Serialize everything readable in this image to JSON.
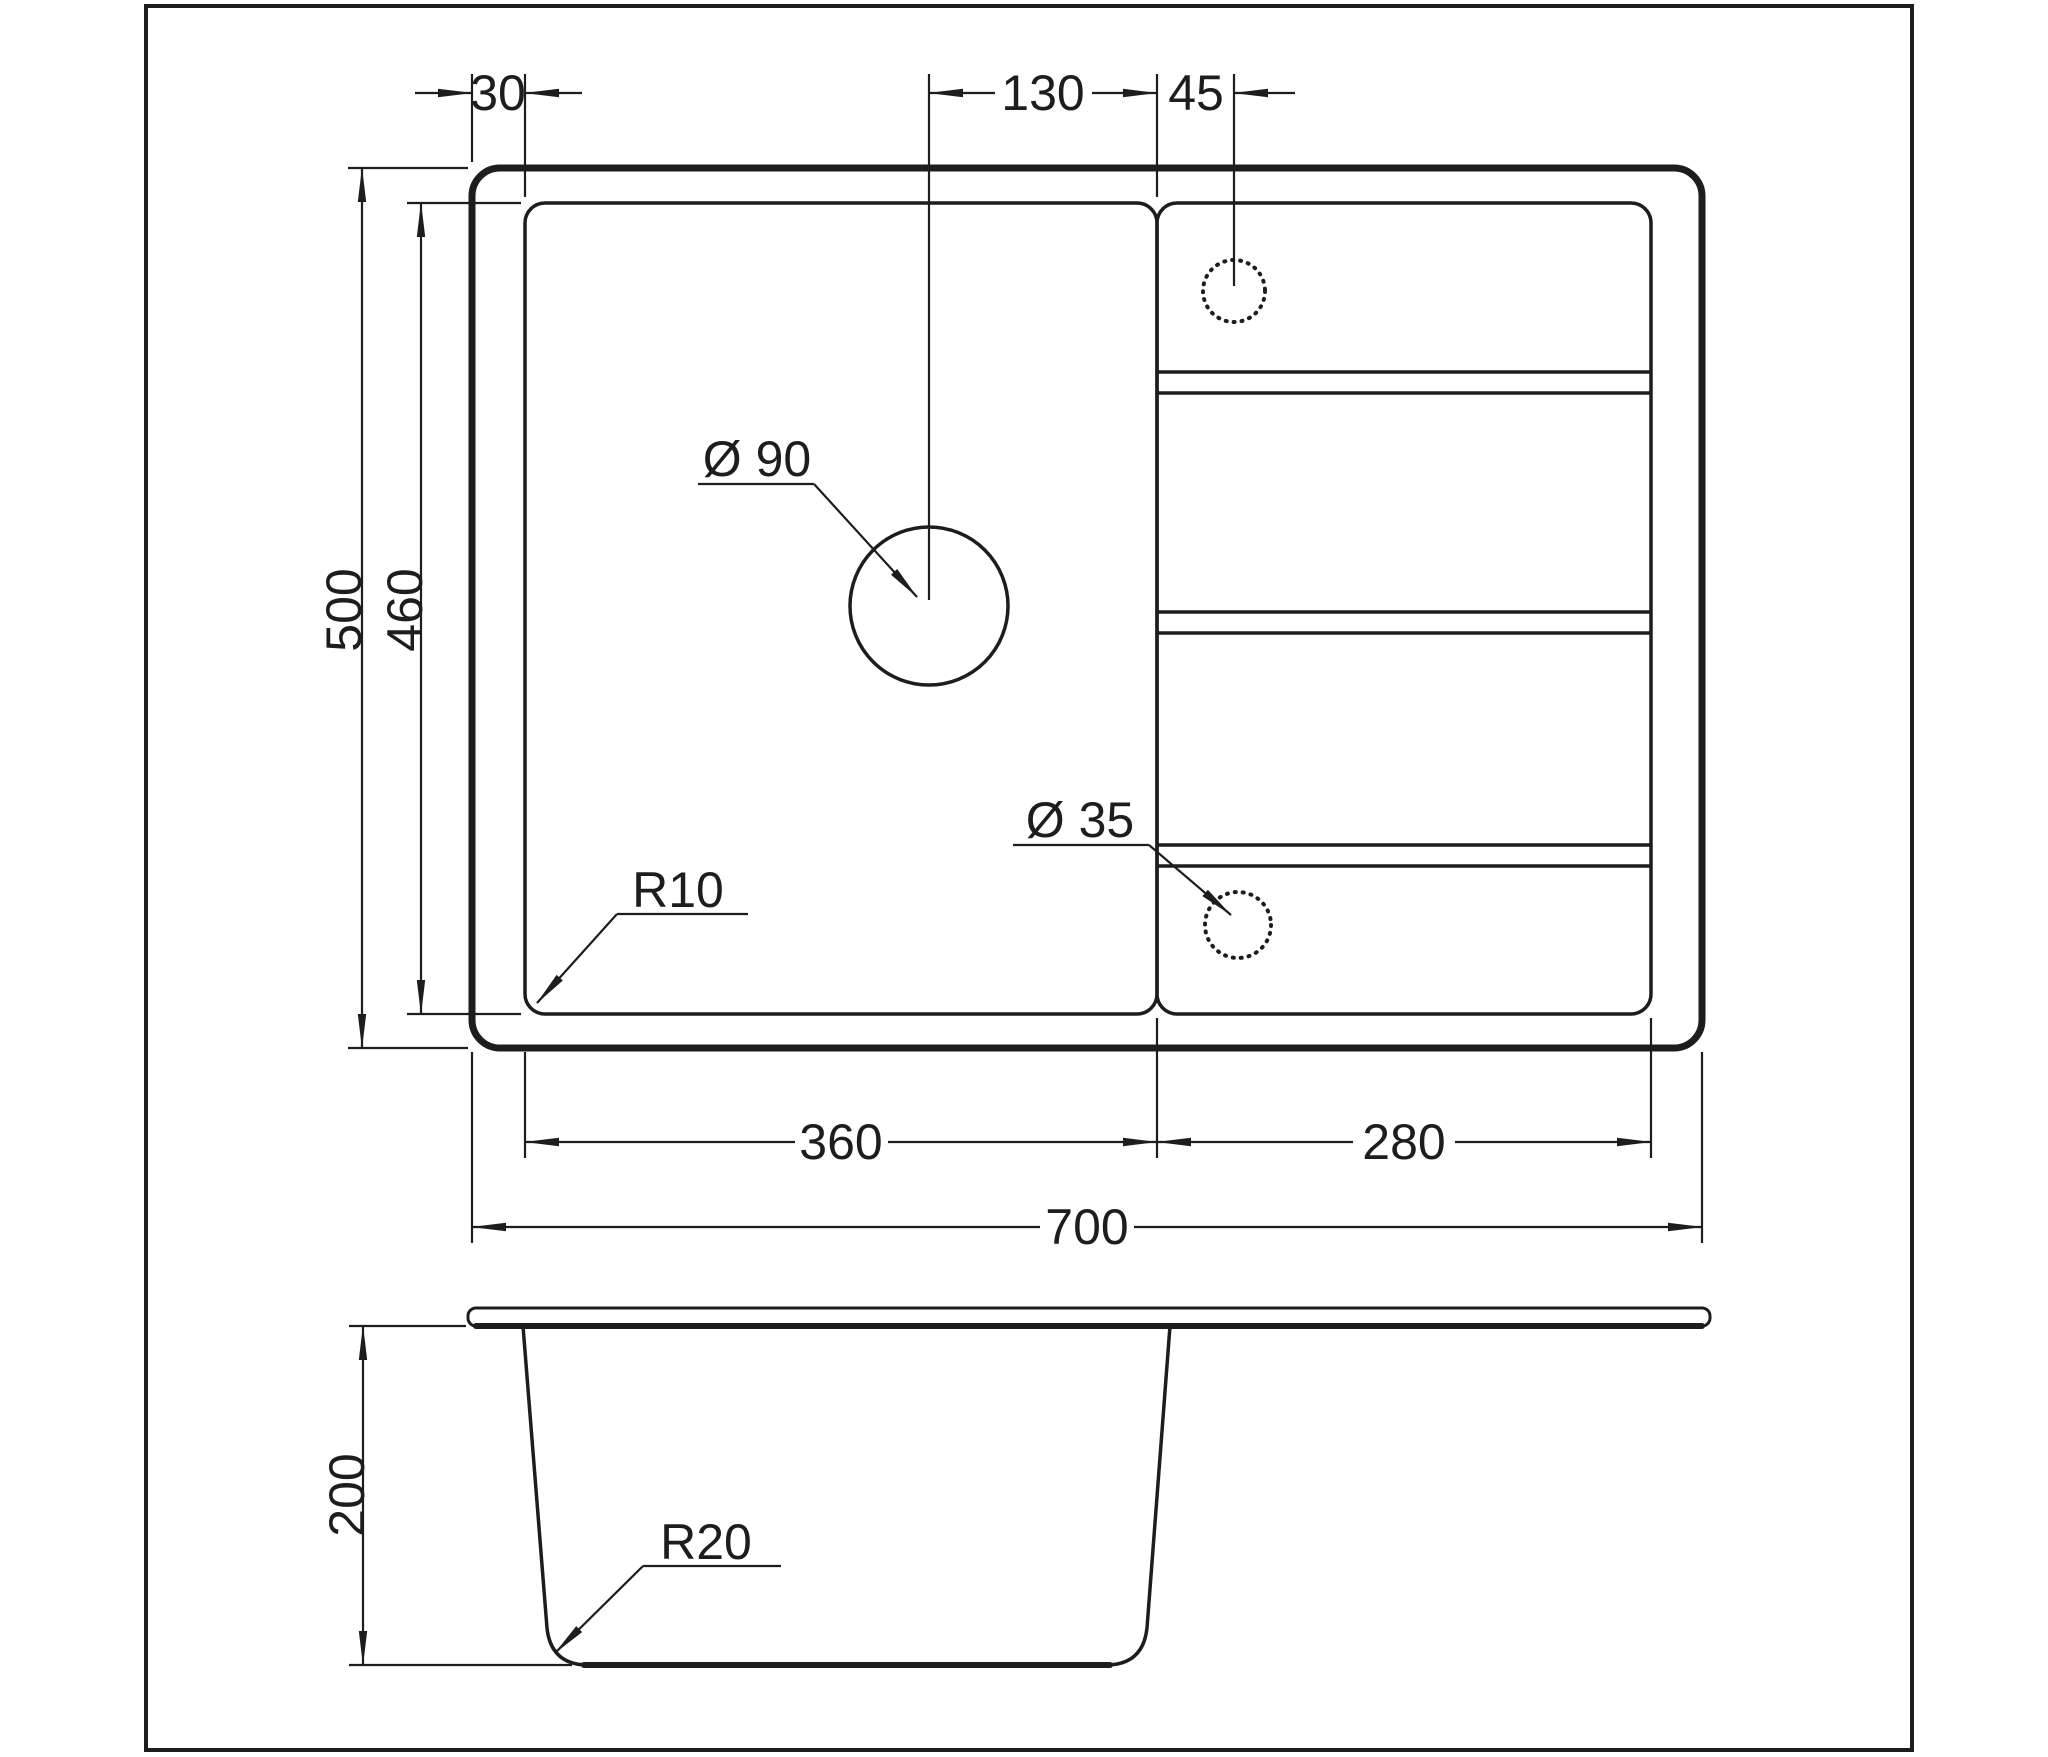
{
  "drawing": {
    "type": "technical-drawing",
    "views": [
      "top-view",
      "side-section-view"
    ],
    "colors": {
      "line": "#1d1d1b",
      "background": "#ffffff"
    },
    "top_view": {
      "dim_rim_offset": "30",
      "dim_drain_to_bowl_edge": "130",
      "dim_bowl_edge_to_faucet": "45",
      "dim_overall_depth": "500",
      "dim_bowl_depth": "460",
      "label_drain_diameter": "Ø 90",
      "label_faucet_hole_diameter": "Ø 35",
      "label_bowl_corner_radius": "R10",
      "dim_bowl_width": "360",
      "dim_drainboard_width": "280",
      "dim_overall_width": "700"
    },
    "side_view": {
      "dim_bowl_height": "200",
      "label_bottom_corner_radius": "R20"
    }
  }
}
